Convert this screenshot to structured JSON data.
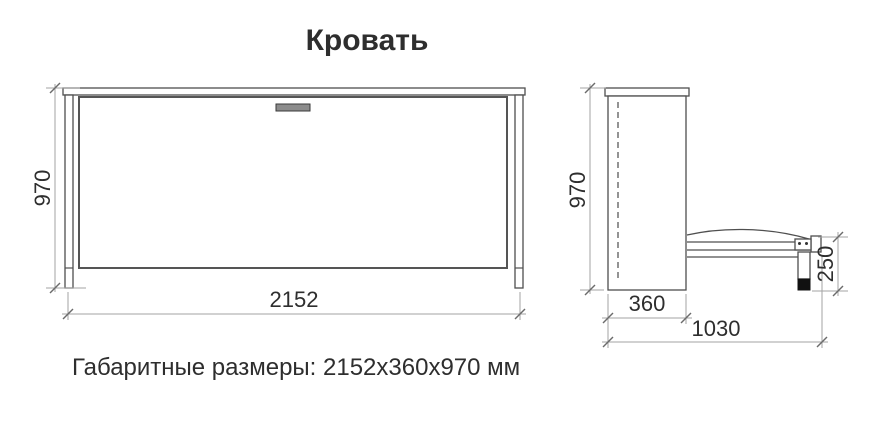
{
  "title": "Кровать",
  "caption": "Габаритные размеры: 2152х360х970 мм",
  "drawing": {
    "front_view": {
      "width_label": "2152",
      "height_label": "970"
    },
    "side_view": {
      "height_label": "970",
      "depth_label": "360",
      "length_label": "1030",
      "leg_height_label": "250"
    }
  },
  "colors": {
    "outline": "#4f4f4f",
    "panel_outline": "#555555",
    "dim_line": "#a3a3a3",
    "tick": "#6b6b6b",
    "handle_fill": "#8c8c8c",
    "foot_fill": "#111111",
    "text": "#2e2e2e",
    "background": "#ffffff"
  }
}
